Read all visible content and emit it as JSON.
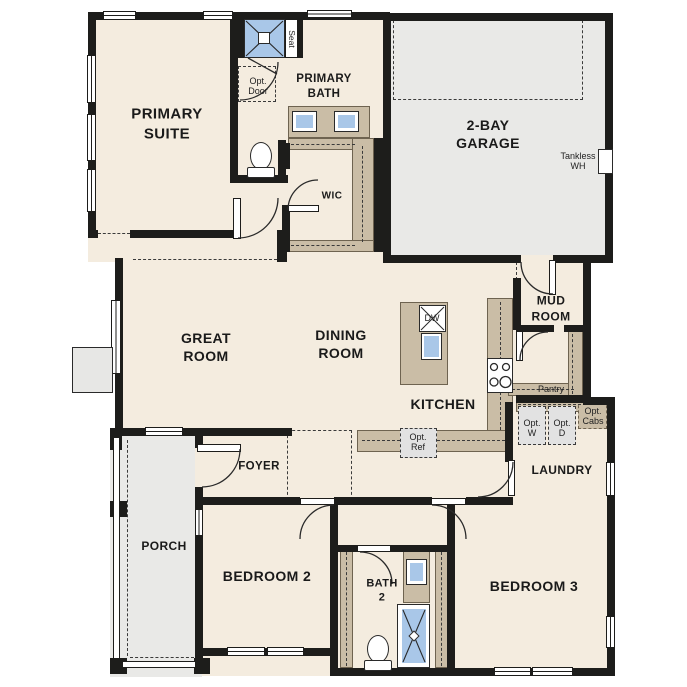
{
  "palette": {
    "floor": "#f4ecdf",
    "garage_floor": "#e9e9e7",
    "counter": "#cabda6",
    "fixture_blue": "#a9c7e8",
    "optional_gray": "#e2e2e2",
    "wall": "#1d1d1b",
    "dash": "#3a3a3a"
  },
  "rooms": {
    "primary_suite": "PRIMARY\nSUITE",
    "primary_bath": "PRIMARY\nBATH",
    "garage": "2-BAY\nGARAGE",
    "wic": "WIC",
    "great_room": "GREAT\nROOM",
    "dining_room": "DINING\nROOM",
    "kitchen": "KITCHEN",
    "mud_room": "MUD\nROOM",
    "pantry": "Pantry",
    "laundry": "LAUNDRY",
    "foyer": "FOYER",
    "porch": "PORCH",
    "bedroom2": "BEDROOM 2",
    "bedroom3": "BEDROOM 3",
    "bath2": "BATH\n2"
  },
  "annotations": {
    "seat": "Seat",
    "opt_door": "Opt.\nDoor",
    "tankless_wh": "Tankless\nWH",
    "dishwasher": "DW",
    "opt_ref": "Opt.\nRef",
    "opt_washer": "Opt.\nW",
    "opt_dryer": "Opt.\nD",
    "opt_cabs": "Opt.\nCabs"
  }
}
